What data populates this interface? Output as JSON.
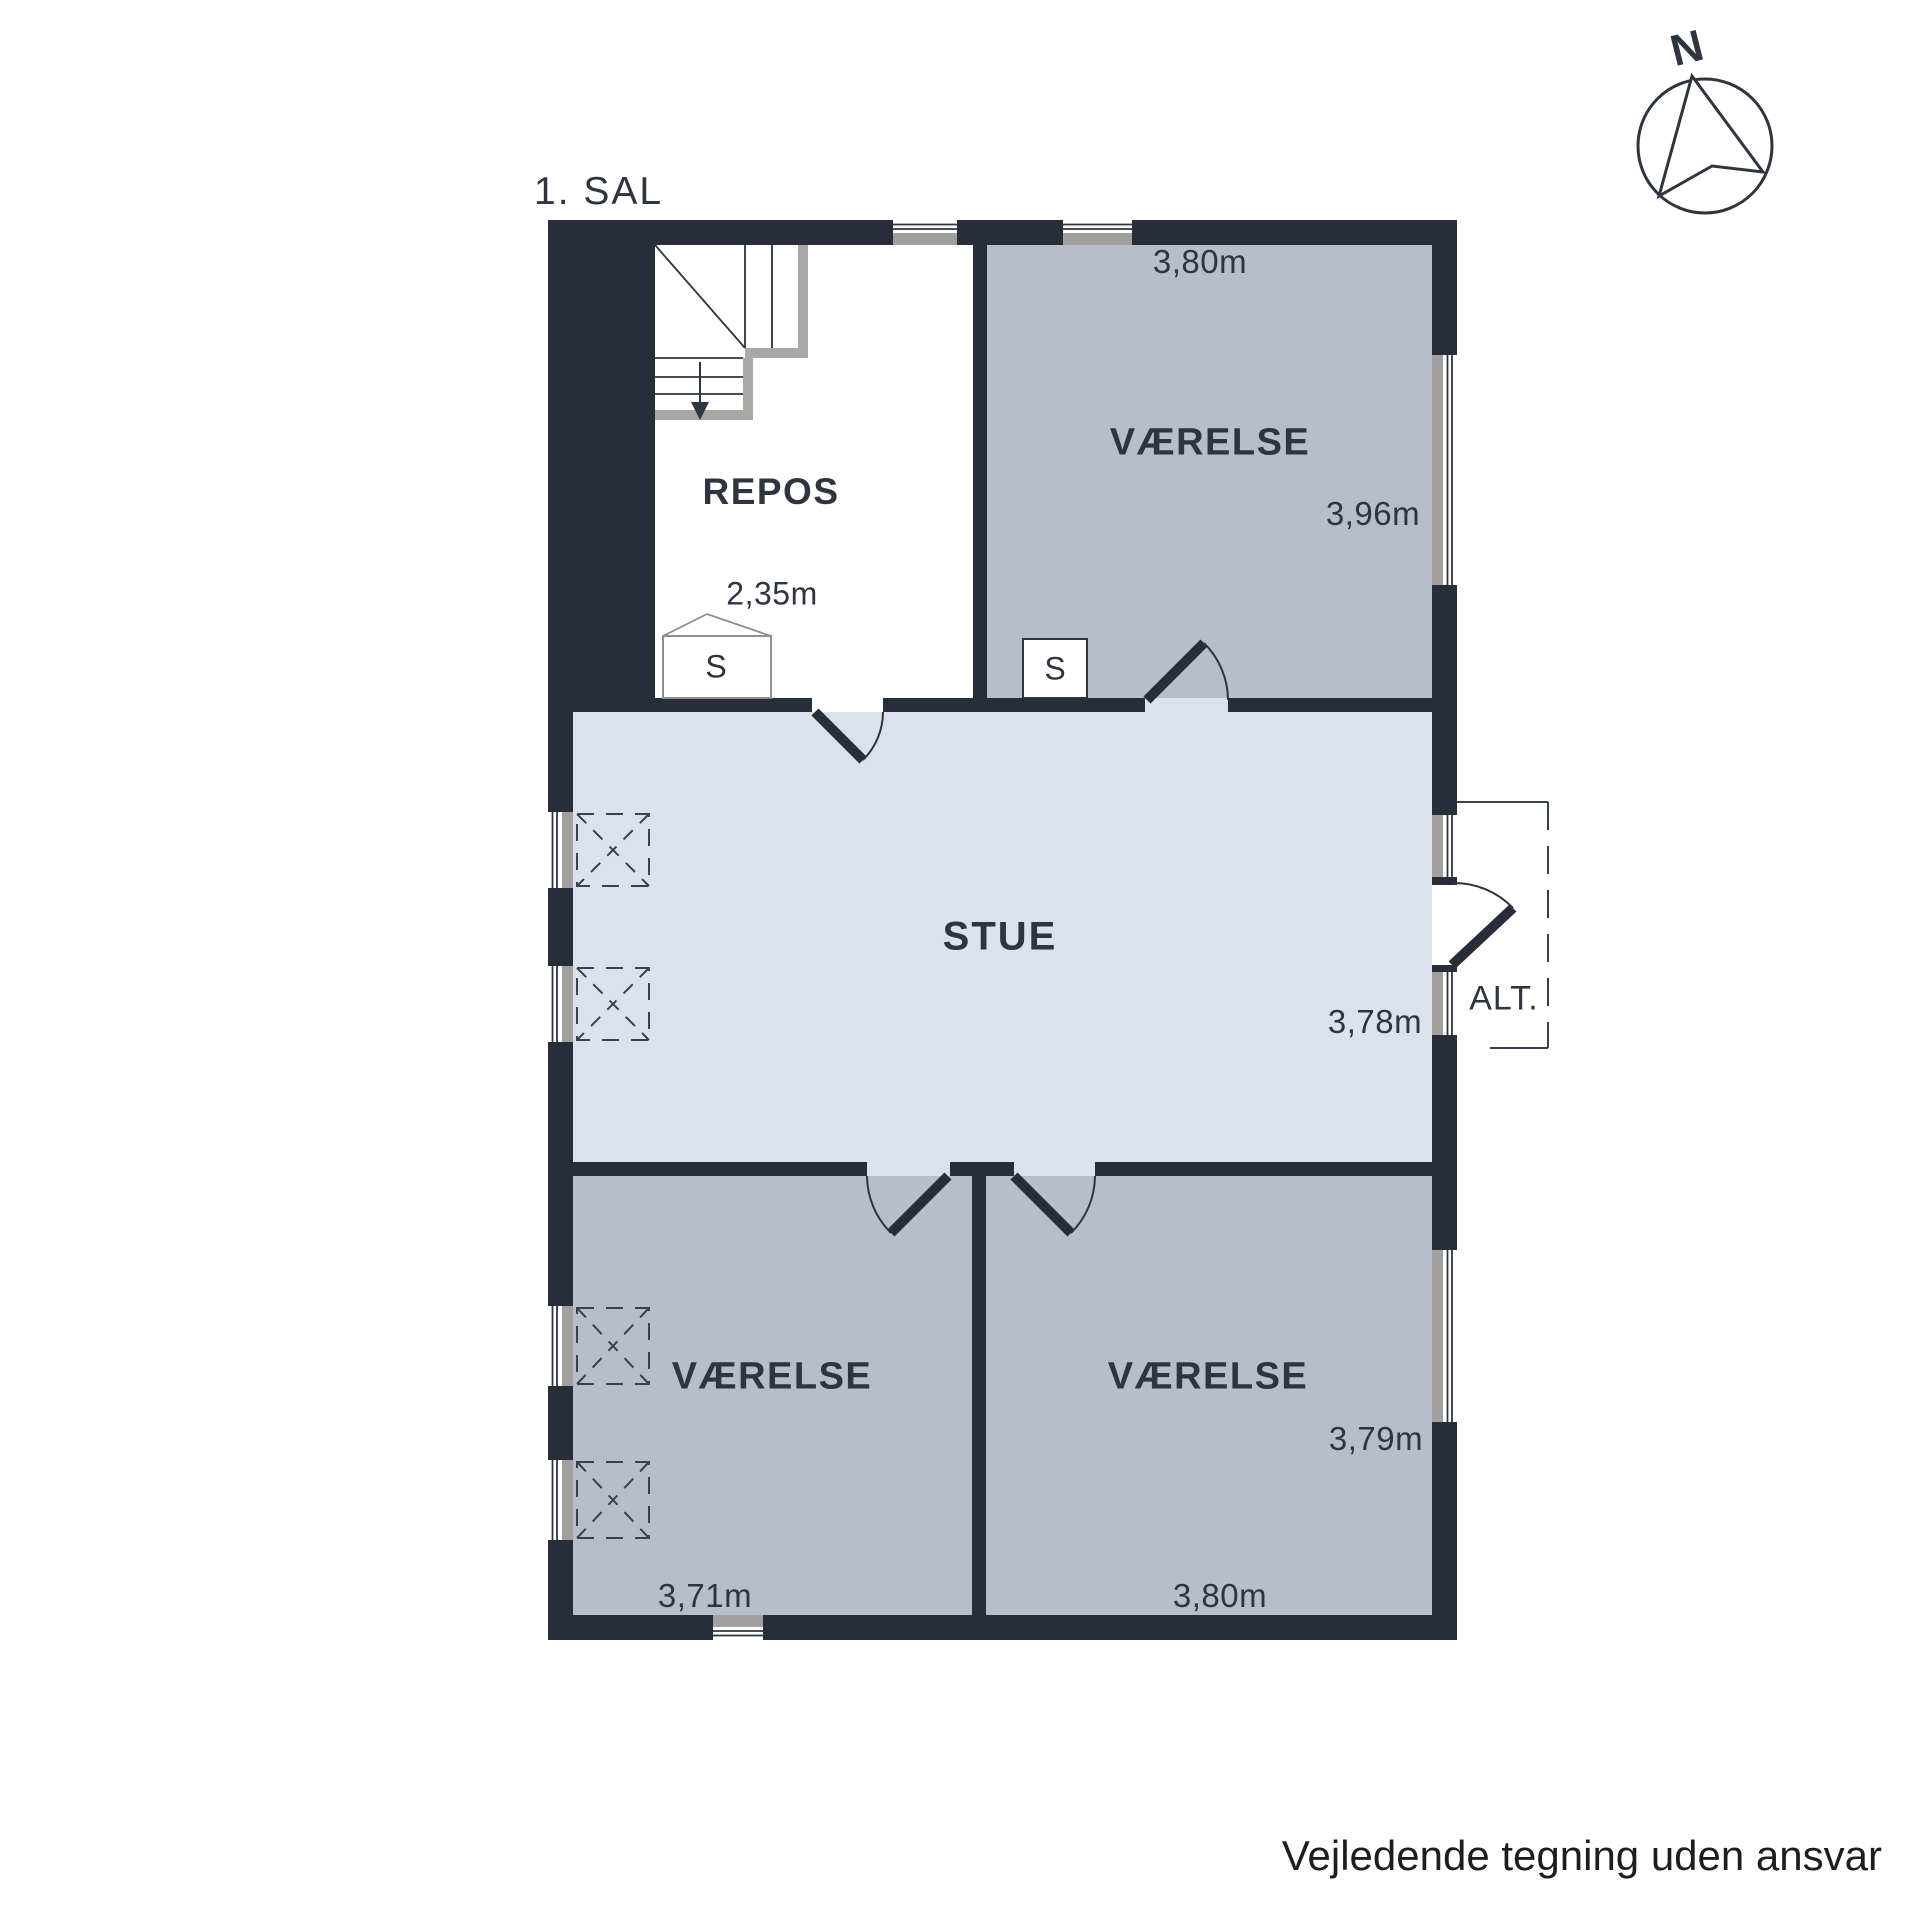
{
  "title": "1. SAL",
  "compass": {
    "label": "N"
  },
  "footer": {
    "disclaimer": "Vejledende tegning uden ansvar"
  },
  "rooms": {
    "repos": {
      "label": "REPOS",
      "dim_width": "2,35m",
      "closet": "S"
    },
    "bedroom_ne": {
      "label": "VÆRELSE",
      "dim_top": "3,80m",
      "dim_right": "3,96m",
      "closet": "S"
    },
    "living": {
      "label": "STUE",
      "dim_right": "3,78m"
    },
    "bedroom_sw": {
      "label": "VÆRELSE",
      "dim_bottom": "3,71m"
    },
    "bedroom_se": {
      "label": "VÆRELSE",
      "dim_bottom": "3,80m",
      "dim_right": "3,79m"
    },
    "balcony": {
      "label": "ALT."
    }
  },
  "colors": {
    "paper": "#ffffff",
    "wall": "#272e3a",
    "room": "#b7bdc9",
    "living": "#dce1eb",
    "sill": "#a1a09c",
    "stair-gray": "#a9a8a4",
    "line": "#2e3440",
    "text": "#2e3440",
    "footer-text": "#1d1d1f"
  }
}
